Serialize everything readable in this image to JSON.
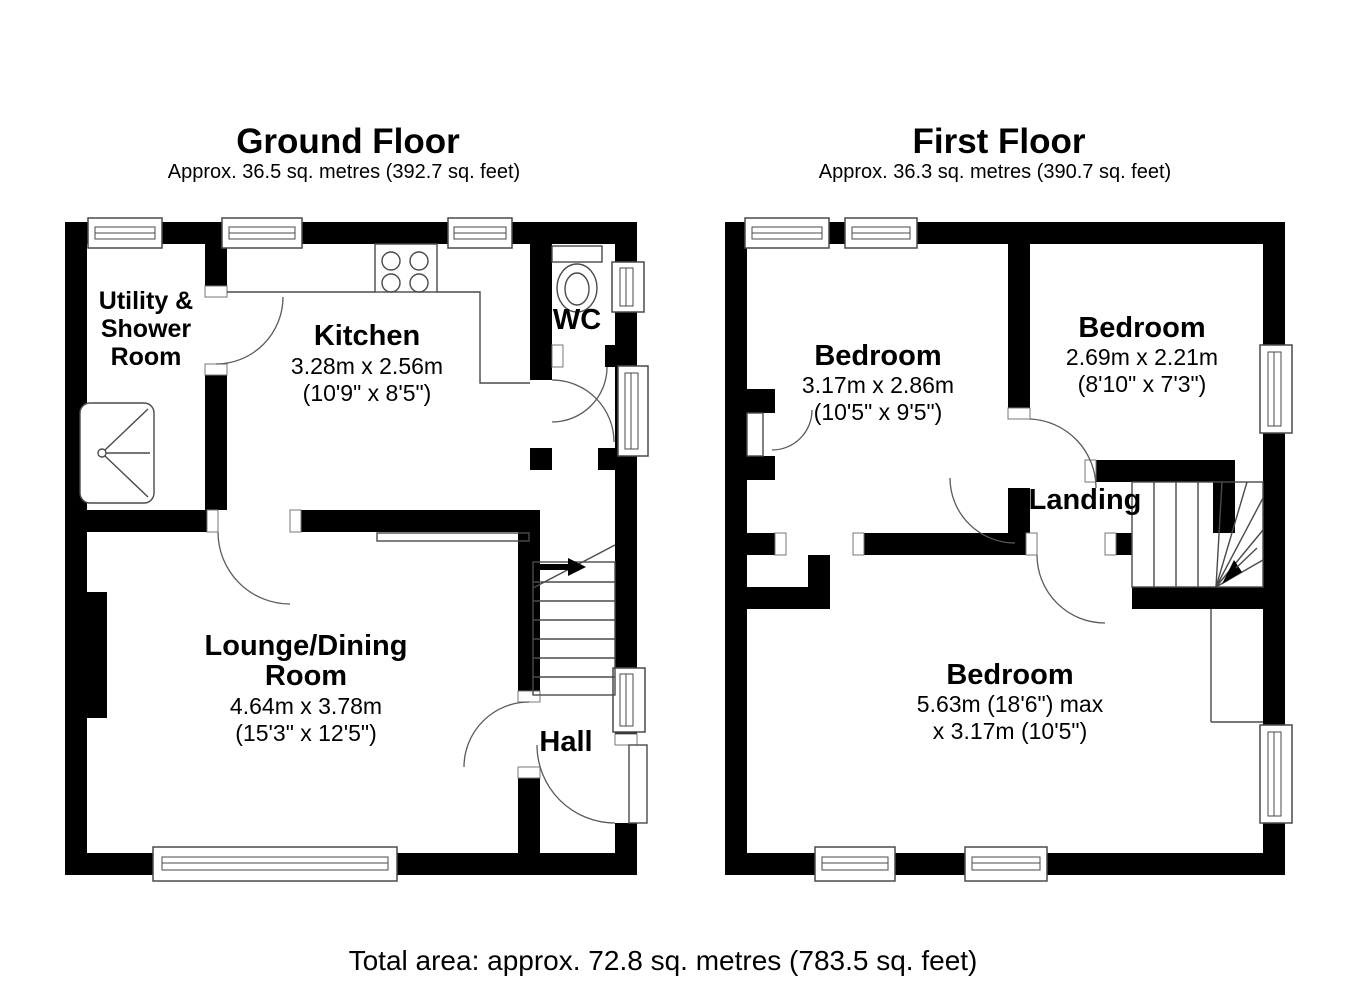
{
  "page": {
    "background": "#ffffff",
    "wall_color": "#000000",
    "total_area": "Total area: approx. 72.8 sq. metres (783.5 sq. feet)"
  },
  "ground_floor": {
    "title": "Ground Floor",
    "subtitle": "Approx. 36.5 sq. metres (392.7 sq. feet)",
    "rooms": {
      "utility_shower": {
        "line1": "Utility &",
        "line2": "Shower",
        "line3": "Room"
      },
      "kitchen": {
        "name": "Kitchen",
        "dims_metric": "3.28m x 2.56m",
        "dims_imperial": "(10'9\" x 8'5\")"
      },
      "wc": {
        "name": "WC"
      },
      "lounge_dining": {
        "name_line1": "Lounge/Dining",
        "name_line2": "Room",
        "dims_metric": "4.64m x 3.78m",
        "dims_imperial": "(15'3\" x 12'5\")"
      },
      "hall": {
        "name": "Hall"
      }
    }
  },
  "first_floor": {
    "title": "First Floor",
    "subtitle": "Approx. 36.3 sq. metres (390.7 sq. feet)",
    "rooms": {
      "bedroom_front": {
        "name": "Bedroom",
        "dims_metric": "3.17m x 2.86m",
        "dims_imperial": "(10'5\" x 9'5\")"
      },
      "bedroom_rear": {
        "name": "Bedroom",
        "dims_metric": "2.69m x 2.21m",
        "dims_imperial": "(8'10\" x 7'3\")"
      },
      "landing": {
        "name": "Landing"
      },
      "bedroom_main": {
        "name": "Bedroom",
        "dims_line1": "5.63m (18'6\") max",
        "dims_line2": "x 3.17m (10'5\")"
      }
    }
  }
}
